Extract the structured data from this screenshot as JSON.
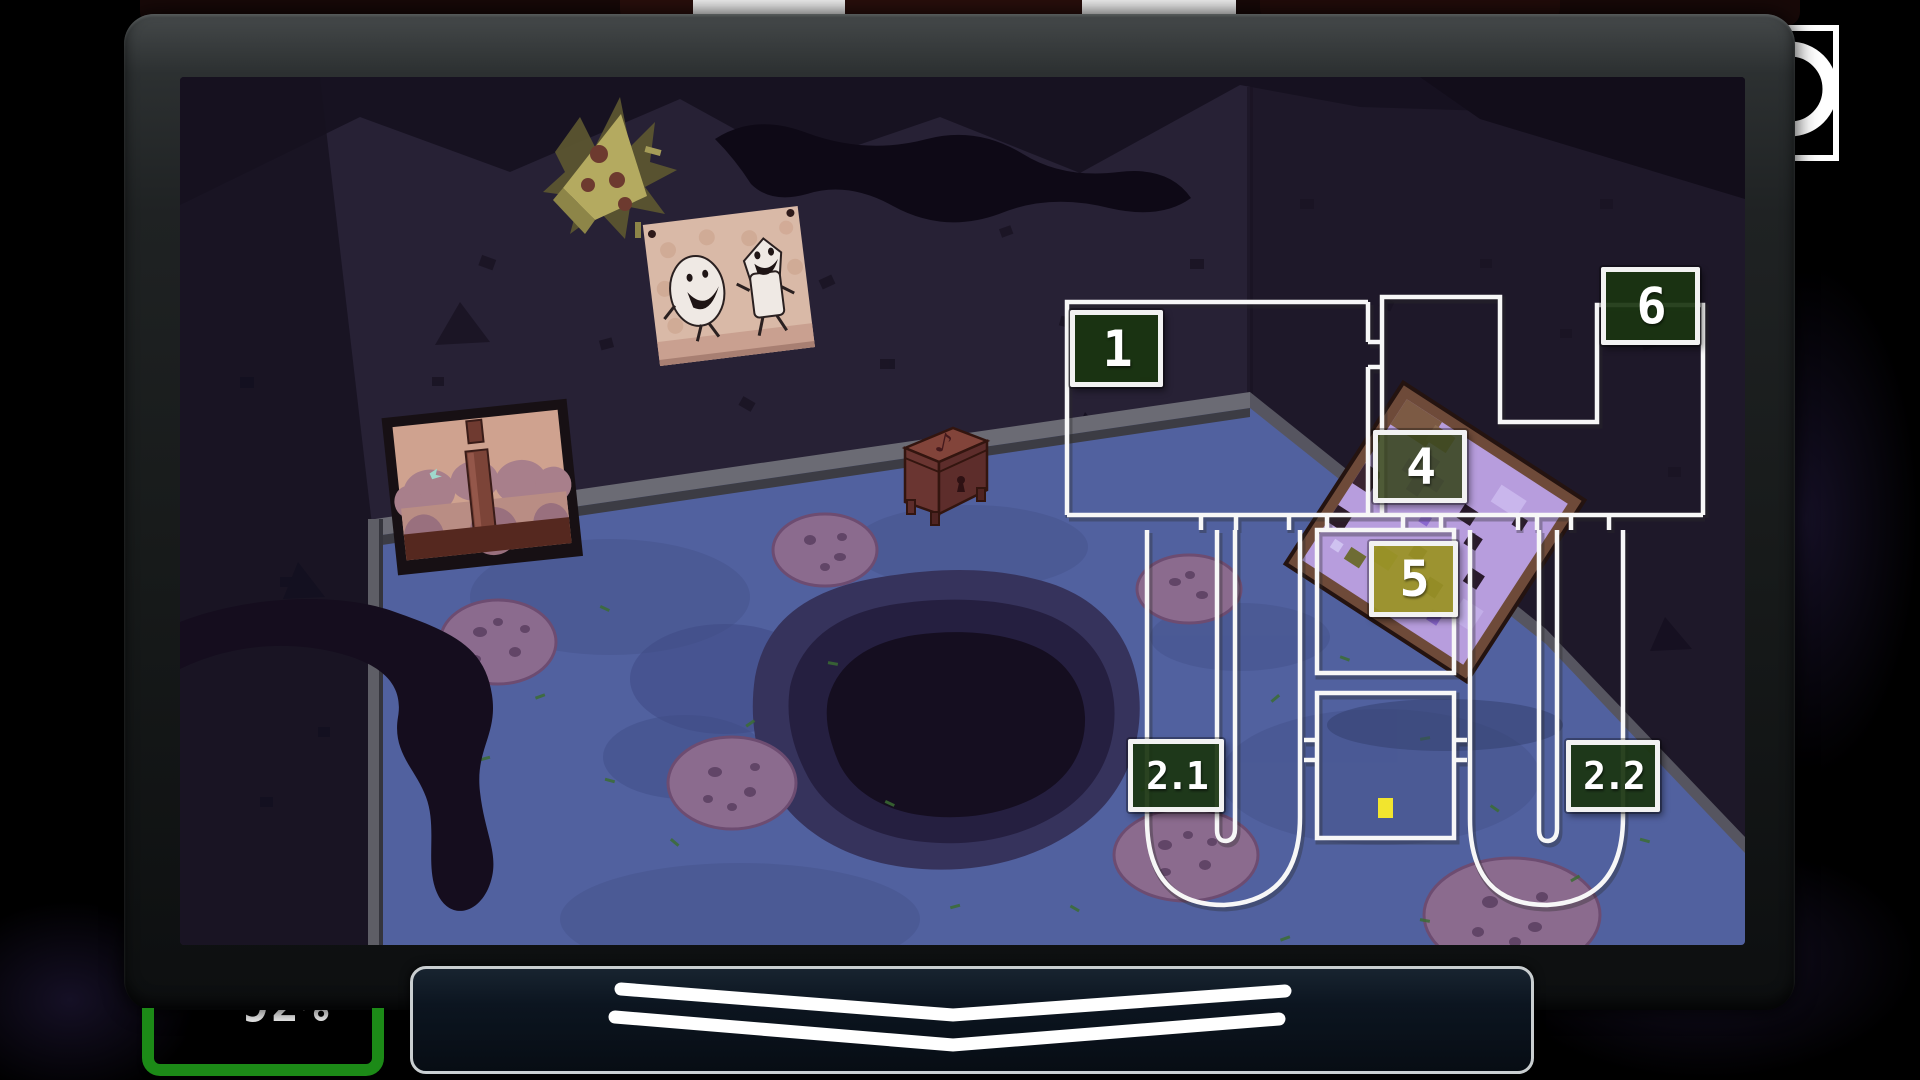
{
  "monitor": {
    "corner_indicator_icon": "ring-icon",
    "bezel_color": "#1f2223"
  },
  "camera_map": {
    "selected_camera": "5",
    "line_color": "#f7f7f7",
    "label_border_color": "#f2f2f2",
    "label_bg_color": "#1a3510",
    "label_bg_color_cam4": "#38461c",
    "selected_bg_color": "#9a9226",
    "player_marker_color": "#f2e52e",
    "cameras": [
      {
        "id": "cam-1",
        "label": "1"
      },
      {
        "id": "cam-6",
        "label": "6"
      },
      {
        "id": "cam-4",
        "label": "4"
      },
      {
        "id": "cam-5",
        "label": "5",
        "selected": true
      },
      {
        "id": "cam-2-1",
        "label": "2.1"
      },
      {
        "id": "cam-2-2",
        "label": "2.2"
      }
    ]
  },
  "power_indicator": {
    "value_text": "92%",
    "bracket_color": "#1c8a17"
  },
  "camera_flip_bar": {
    "icon": "double-chevron-down-icon"
  },
  "scene": {
    "description": "dark cartoon party room viewed on a CRT monitor",
    "objects": [
      {
        "name": "pizza-splat-decoration"
      },
      {
        "name": "dancing-characters-poster"
      },
      {
        "name": "framed-picture"
      },
      {
        "name": "music-box"
      },
      {
        "name": "leaning-pixel-poster"
      },
      {
        "name": "floor-hole"
      },
      {
        "name": "pizza-on-floor",
        "count": 6
      },
      {
        "name": "dark-tentacle-shadow"
      }
    ],
    "colors": {
      "wall": "#272135",
      "floor": "#51619f",
      "hole": "#140e20"
    }
  }
}
